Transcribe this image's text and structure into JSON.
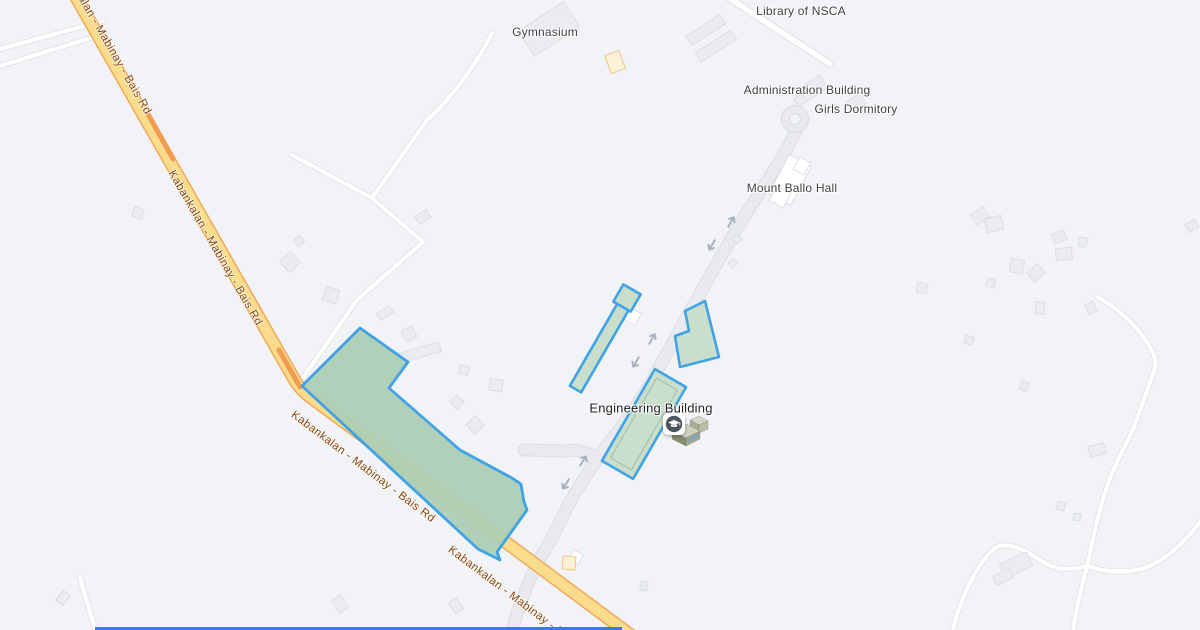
{
  "colors": {
    "land": "#F1F3F6",
    "building_fill": "#EAECEF",
    "building_stroke": "#DCDFE3",
    "building_white": "#FFFFFF",
    "poi_cream_fill": "#FBF1D9",
    "poi_cream_stroke": "#EFC87F",
    "minor_road": "#FFFFFF",
    "minor_road_casing": "#E3E5E9",
    "campus_road": "#E8EAED",
    "campus_road_casing": "#DDE0E4",
    "main_road_fill": "#F9DC8C",
    "main_road_casing": "#F0A95C",
    "road_core": "#F29B51",
    "area_fill": "#ABCDB4",
    "highlight_fill": "#C9DFCC",
    "highlight_stroke": "#3FA3E6",
    "highlight_inner": "#A9C3AC",
    "label": "#3C4043",
    "label_dark": "#202124",
    "road_label": "#82451F",
    "arrow": "#A8B2BF",
    "bottom_bar": "#4178E0",
    "marker_circle": "#4D565E"
  },
  "poi_labels": [
    {
      "id": "library",
      "text": "Library of NSCA"
    },
    {
      "id": "gymnasium",
      "text": "Gymnasium"
    },
    {
      "id": "administration",
      "text": "Administration Building"
    },
    {
      "id": "girls-dormitory",
      "text": "Girls Dormitory"
    },
    {
      "id": "mount-ballo-hall",
      "text": "Mount Ballo Hall"
    },
    {
      "id": "engineering",
      "text": "Engineering Building"
    }
  ],
  "road": {
    "name": "Kabankalan - Mabinay - Bais Rd",
    "label_occurrences": 4
  },
  "marker": {
    "icon": "graduation-cap-icon",
    "attached_to": "Engineering Building",
    "building_icon": "building-3d-icon"
  },
  "map_features": {
    "one_way_arrow_count": 6,
    "roundabout": true,
    "selected_area": "campus parcel polygon",
    "highlighted_building_count": 3
  }
}
